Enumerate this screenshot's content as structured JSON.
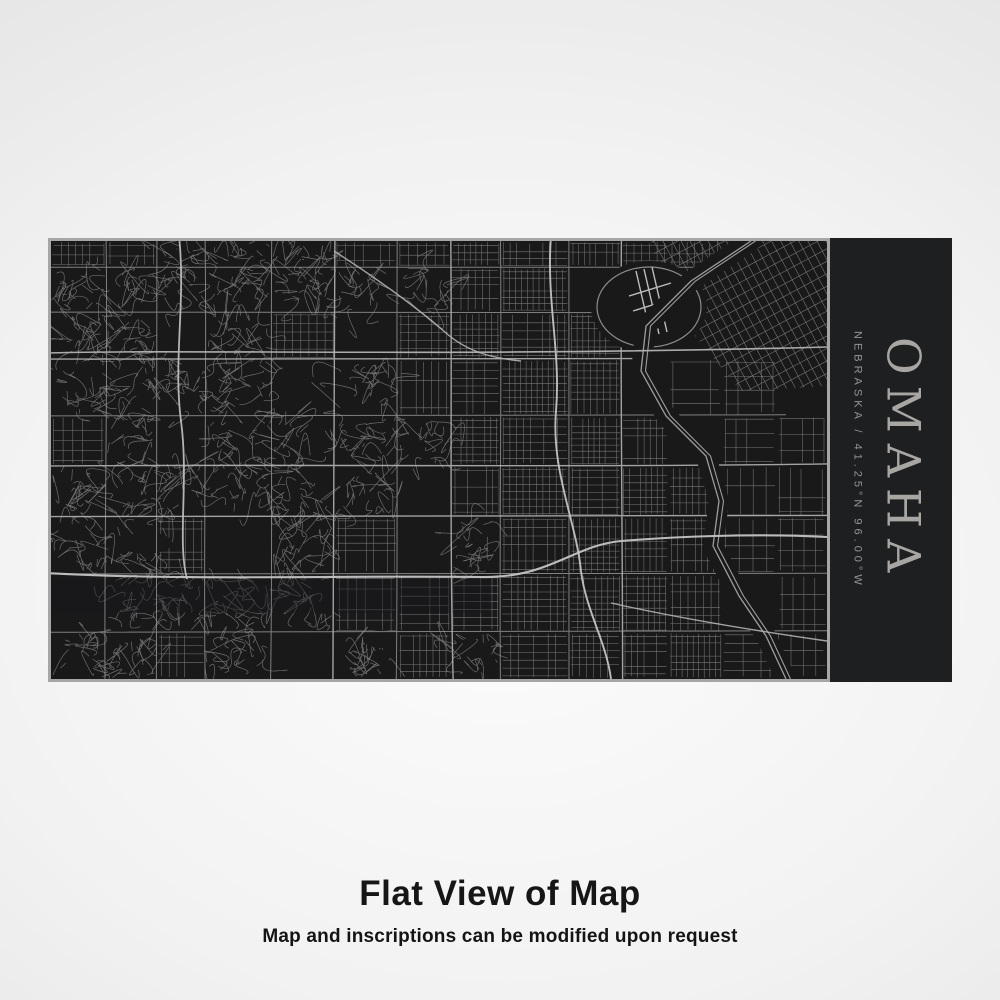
{
  "product_view": {
    "plate": {
      "city": "OMAHA",
      "location_line": "NEBRASKA / 41.25°N 96.00°W",
      "map_description": "Engraved street map of Omaha, Nebraska"
    },
    "caption": {
      "title": "Flat View of Map",
      "subtitle": "Map and inscriptions can be modified upon request"
    },
    "colors": {
      "plate_black": "#1e1f20",
      "map_background": "#19191a",
      "minor_street": "#7b7b7b",
      "curvy_street": "#767676",
      "arterial": "#9a9a9a",
      "arterial_bright": "#b3b3b3",
      "highway": "#c4c4c4",
      "river": "#9e9e9e",
      "frame_border": "#a6a6a6",
      "inscription_city": "#a8a6a3",
      "inscription_location": "#949494",
      "caption_text": "#161616"
    }
  }
}
